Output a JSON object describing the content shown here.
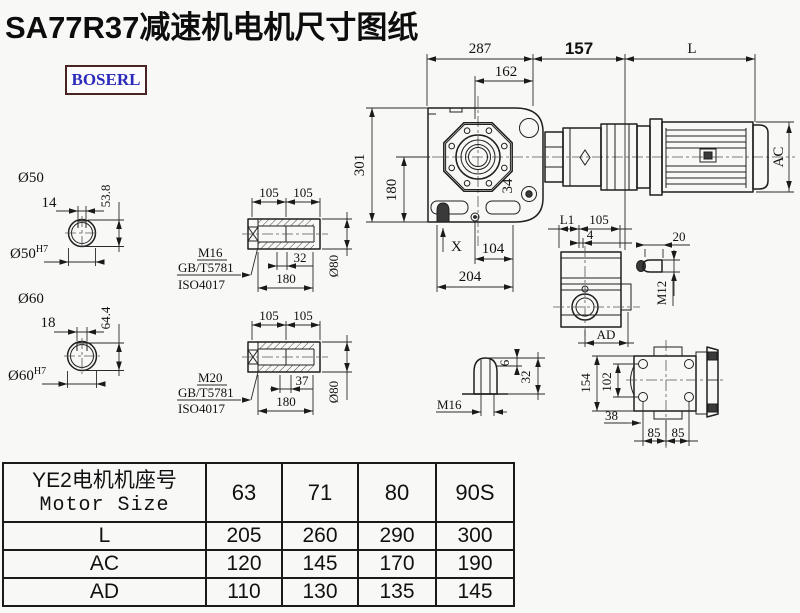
{
  "page": {
    "title": "SA77R37减速机电机尺寸图纸",
    "logo": "BOSERL"
  },
  "main_view": {
    "dim_287": "287",
    "dim_162": "162",
    "dim_157": "157",
    "dim_L": "L",
    "dim_301": "301",
    "dim_180": "180",
    "dim_AC": "AC",
    "dim_34": "34",
    "mark_X": "X",
    "dim_104": "104",
    "dim_204": "204"
  },
  "shaft_50": {
    "title": "Ø50",
    "dim_keyway_width": "14",
    "dim_key_height": "53.8",
    "bore": "Ø50",
    "bore_tolerance": "H7"
  },
  "shaft_60": {
    "title": "Ø60",
    "dim_keyway_width": "18",
    "dim_key_height": "64.4",
    "bore": "Ø60",
    "bore_tolerance": "H7"
  },
  "hollow_shaft_a": {
    "dim_105_left": "105",
    "dim_105_right": "105",
    "dim_32": "32",
    "dim_180": "180",
    "dim_dia": "Ø80",
    "bolt": "M16",
    "std_1": "GB/T5781",
    "std_2": "ISO4017"
  },
  "hollow_shaft_b": {
    "dim_105_left": "105",
    "dim_105_right": "105",
    "dim_37": "37",
    "dim_180": "180",
    "dim_dia": "Ø80",
    "bolt": "M20",
    "std_1": "GB/T5781",
    "std_2": "ISO4017"
  },
  "side_view": {
    "dim_L1": "L1",
    "dim_105": "105",
    "dim_4": "4",
    "dim_AD": "AD"
  },
  "key_view": {
    "dim_20": "20",
    "thread": "M12"
  },
  "plug_view": {
    "dim_6": "6",
    "dim_32": "32",
    "thread": "M16"
  },
  "rear_view": {
    "dim_154": "154",
    "dim_102": "102",
    "dim_38": "38",
    "dim_85_left": "85",
    "dim_85_right": "85"
  },
  "table": {
    "header_cn": "YE2电机机座号",
    "header_en": "Motor Size",
    "sizes": [
      "63",
      "71",
      "80",
      "90S"
    ],
    "rows": [
      {
        "label": "L",
        "values": [
          "205",
          "260",
          "290",
          "300"
        ]
      },
      {
        "label": "AC",
        "values": [
          "120",
          "145",
          "170",
          "190"
        ]
      },
      {
        "label": "AD",
        "values": [
          "110",
          "130",
          "135",
          "145"
        ]
      }
    ]
  }
}
